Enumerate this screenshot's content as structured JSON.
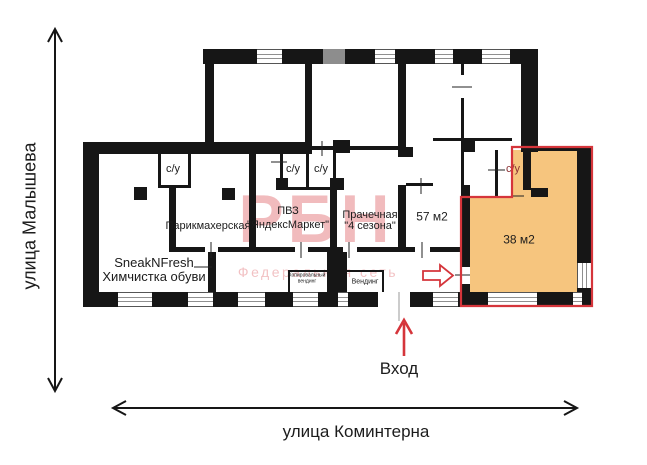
{
  "streets": {
    "vertical": "улица Малышева",
    "horizontal": "улица Коминтерна"
  },
  "entrance": {
    "label": "Вход"
  },
  "watermark": {
    "title": "РБН",
    "subtitle": "Федеральная сеть"
  },
  "rooms": {
    "sneaknfresh": {
      "name": "SneakNFresh",
      "subtitle": "Химчистка обуви"
    },
    "hairdresser": {
      "name": "Парикмахерская"
    },
    "pickup_point": {
      "name": "ПВЗ",
      "subtitle": "\"ЯндексМаркет\""
    },
    "laundry": {
      "name": "Прачечная",
      "subtitle": "\"4 сезона\""
    },
    "unit_57": {
      "area": "57 м2"
    },
    "unit_38": {
      "area": "38 м2"
    },
    "copy_vending": {
      "name": "Копировальный",
      "subtitle": "вендинг"
    },
    "vending": {
      "name": "Вендинг"
    },
    "bathroom": {
      "label": "с/у"
    }
  },
  "colors": {
    "wall": "#161616",
    "highlight": "#F6C57E",
    "outline": "#D5353B",
    "watermark": "#D5353B",
    "window_line": "#8f8f8f",
    "gray_wall": "#8d8d8d"
  }
}
